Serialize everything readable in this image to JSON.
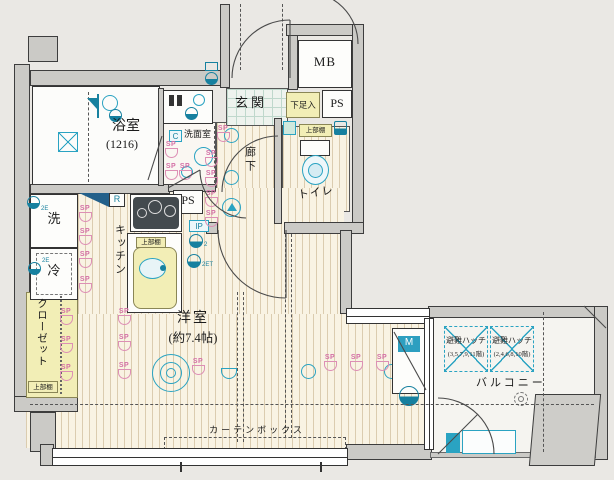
{
  "plan_type": "floor-plan",
  "labels": {
    "bath": "浴室",
    "bath_size": "(1216)",
    "mb": "MB",
    "ps": "PS",
    "ip": "IP",
    "c": "C",
    "r": "R",
    "m": "M",
    "genkan": "玄関",
    "shoe_box": "下足入",
    "upper_shelf": "上部棚",
    "washroom": "洗面室",
    "corridor": "廊下",
    "toilet": "トイレ",
    "kitchen": "キッチン",
    "washer": "洗",
    "fridge": "冷",
    "closet": "クローゼット",
    "room": "洋室",
    "room_size": "(約7.4帖)",
    "curtain_box": "カーテンボックス",
    "balcony": "バルコニー",
    "sp": "SP",
    "outlet_2e": "2E",
    "outlet_2": "2",
    "outlet_2et": "2ET"
  },
  "hatches": [
    {
      "name": "避難ハッチ",
      "floors": "(3,5,7,9,11階)"
    },
    {
      "name": "避難ハッチ",
      "floors": "(2,4,6,8,10階)"
    }
  ],
  "colors": {
    "accent_teal": "#2aa3c2",
    "accent_pink": "#d883ad",
    "fixture_yellow": "#f2eeb6",
    "wall_gray": "#cbcac6",
    "background": "#eae8e4"
  }
}
